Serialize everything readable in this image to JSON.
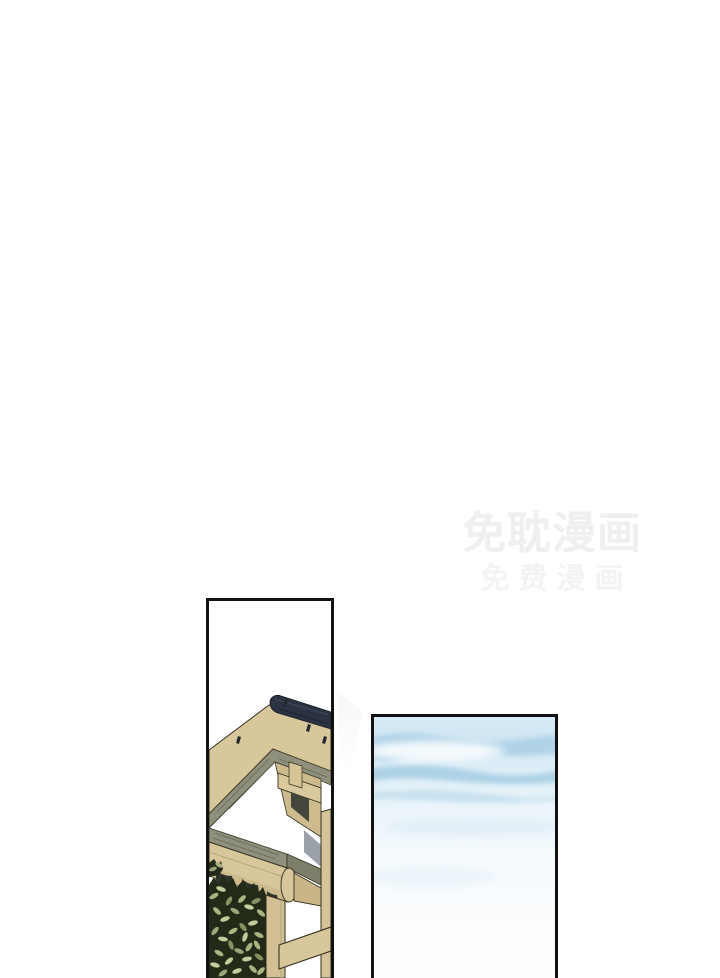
{
  "page": {
    "type": "webtoon-comic-page",
    "background": "#ffffff"
  },
  "watermark": {
    "line1": "免耽漫画",
    "line2": "免费漫画",
    "color": "#efefed"
  },
  "panels": {
    "left": {
      "label": "building-eaves-panel",
      "illustration": "traditional-wooden-eaves-corner-with-foliage",
      "border_color": "#111111",
      "colors": {
        "roof_tan": "#d9c79c",
        "ridge_navy": "#2b3342",
        "ridge_outline": "#141a24",
        "soffit_olive": "#8e907c",
        "soffit_olive_dark": "#7c7e6a",
        "gable_tan": "#cdbb8e",
        "beam_tan": "#dbc99e",
        "fascia_side_tan": "#c9b586",
        "post_tan": "#d2bf94",
        "right_post_tan": "#d6c398",
        "inner_shadow": "#45463b",
        "wall_shadow_gray": "#9aa1a9",
        "scallop_dark": "#2f322a",
        "foliage_dark": "#232a18",
        "leaf_green": "#a9b480",
        "leaf_light": "#c3cc9a",
        "leaf_deep": "#849362",
        "outline": "#33301f"
      }
    },
    "right": {
      "label": "sky-panel",
      "illustration": "soft-blue-sky-with-cloud-streaks",
      "border_color": "#111111",
      "colors": {
        "sky_top": "#d8ebf6",
        "cloud_blue": "#9dc8e0",
        "cloud_blue_light": "#b4d5e8",
        "sky_bottom": "#fdfeff"
      }
    }
  }
}
